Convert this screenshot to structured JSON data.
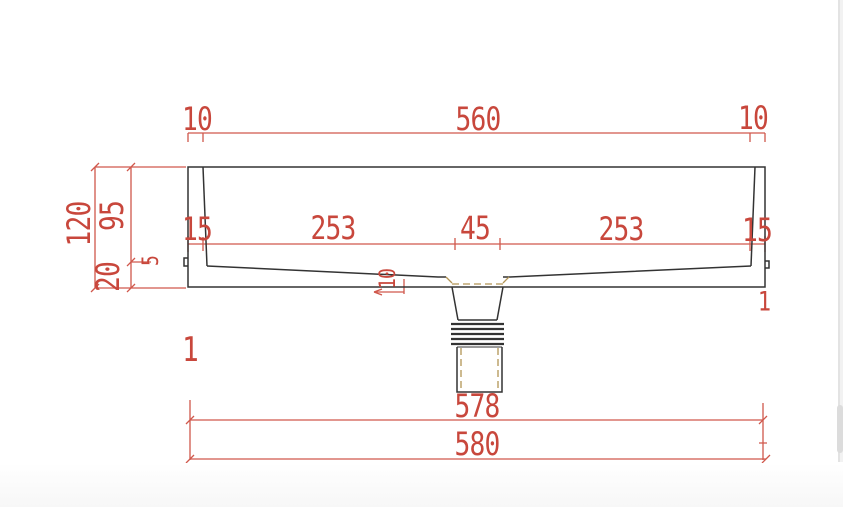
{
  "drawing": {
    "type": "technical-section-drawing",
    "subject": "wash-basin cross section with drain pipe",
    "colors": {
      "dimension_red": "#c8473c",
      "outline_black": "#333333",
      "hidden_tan": "#b29455",
      "background": "#ffffff"
    },
    "dims": {
      "top_left": "10",
      "top_center": "560",
      "top_right": "10",
      "mid": [
        "15",
        "253",
        "45",
        "253",
        "15"
      ],
      "left_total": "120",
      "left_depth": "95",
      "left_base": "20",
      "left_notch": "5",
      "drain_drop": "10",
      "bottom_inner": "578",
      "bottom_outer": "580",
      "stray_left": "1",
      "stray_right": "1"
    }
  }
}
